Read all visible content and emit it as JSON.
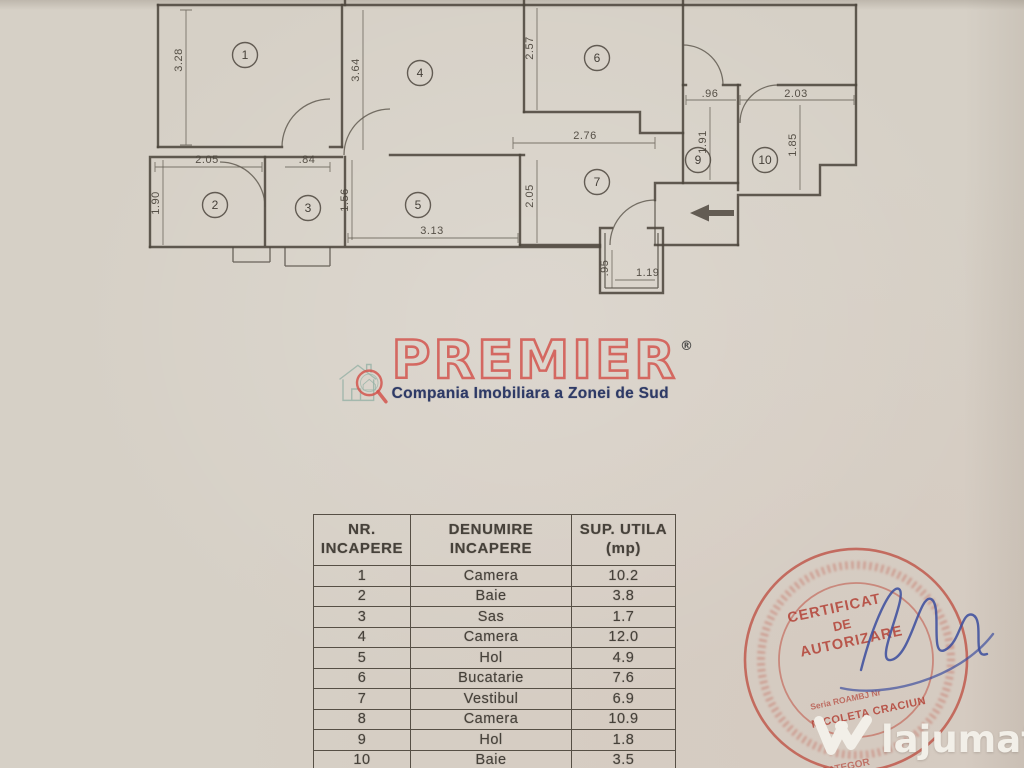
{
  "floor_plan": {
    "rooms": {
      "r1": "1",
      "r2": "2",
      "r3": "3",
      "r4": "4",
      "r5": "5",
      "r6": "6",
      "r7": "7",
      "r9": "9",
      "r10": "10"
    },
    "dims": {
      "h_room1": "3.28",
      "h_room4": "3.64",
      "h_room6": "2.57",
      "w_hall7": "2.76",
      "h_hall7": "2.05",
      "w_room9": ".96",
      "h_room9": "1.91",
      "w_room10": "2.03",
      "h_room10": "1.85",
      "w_room2": "2.05",
      "h_room2": "1.90",
      "w_door3": ".84",
      "h_room3": "1.56",
      "w_room5": "3.13",
      "w_entry": "1.19",
      "h_entry": ".95"
    }
  },
  "logo": {
    "brand": "PREMIER",
    "registered": "®",
    "tagline": "Compania Imobiliara a Zonei de Sud"
  },
  "table": {
    "col1_line1": "NR.",
    "col1_line2": "INCAPERE",
    "col2_line1": "DENUMIRE",
    "col2_line2": "INCAPERE",
    "col3_line1": "SUP. UTILA",
    "col3_line2": "(mp)",
    "rows": [
      {
        "nr": "1",
        "name": "Camera",
        "area": "10.2"
      },
      {
        "nr": "2",
        "name": "Baie",
        "area": "3.8"
      },
      {
        "nr": "3",
        "name": "Sas",
        "area": "1.7"
      },
      {
        "nr": "4",
        "name": "Camera",
        "area": "12.0"
      },
      {
        "nr": "5",
        "name": "Hol",
        "area": "4.9"
      },
      {
        "nr": "6",
        "name": "Bucatarie",
        "area": "7.6"
      },
      {
        "nr": "7",
        "name": "Vestibul",
        "area": "6.9"
      },
      {
        "nr": "8",
        "name": "Camera",
        "area": "10.9"
      },
      {
        "nr": "9",
        "name": "Hol",
        "area": "1.8"
      },
      {
        "nr": "10",
        "name": "Baie",
        "area": "3.5"
      }
    ]
  },
  "stamp": {
    "line1": "CERTIFICAT",
    "line2": "DE",
    "line3": "AUTORIZARE",
    "serial": "Seria ROAMBJ Nr",
    "name": "NICOLETA CRACIUN",
    "bottom_partial": "CATEGOR"
  },
  "watermark": {
    "site": "lajumate",
    "tld": ".ro"
  }
}
